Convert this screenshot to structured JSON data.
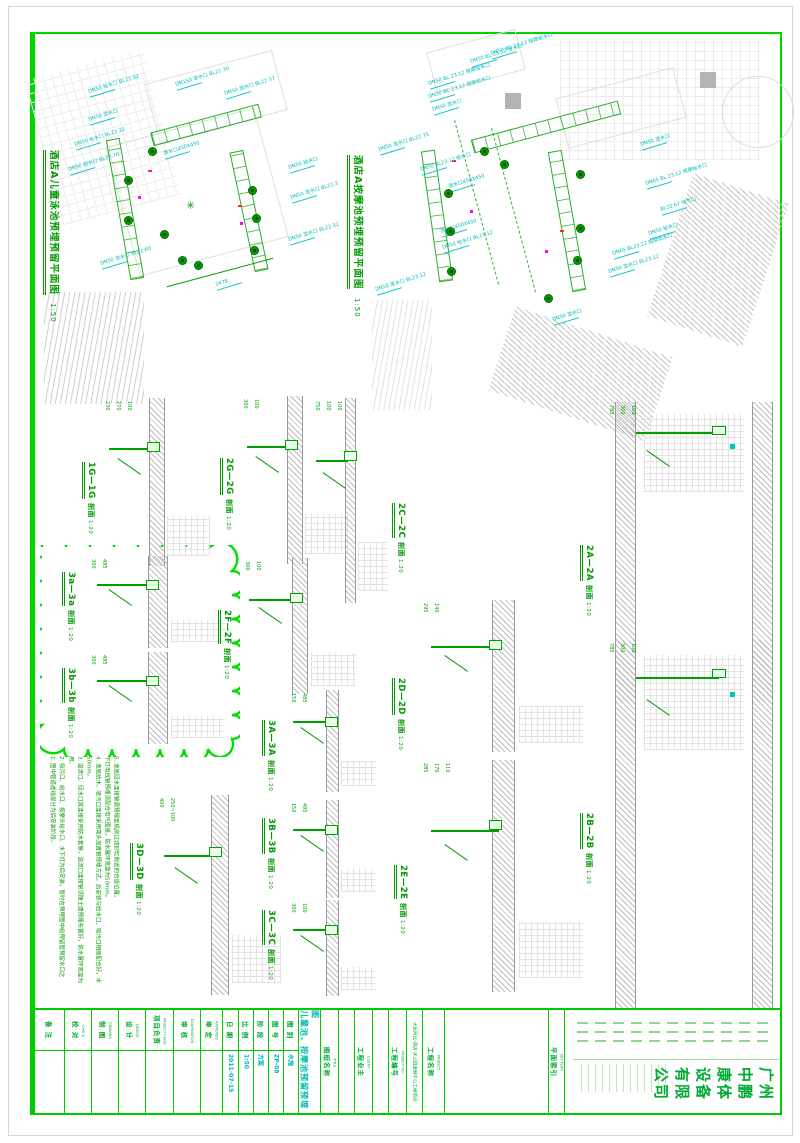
{
  "sheet": {
    "frame_color": "#00d500",
    "drawing_green": "#00a000",
    "label_cyan": "#00b8b8",
    "plan1": {
      "title": "酒店A儿童泳池预埋预留平面图",
      "scale": "1:50",
      "labels": [
        {
          "t": "DN50 给水口 BL22.32",
          "x": 88,
          "y": 90
        },
        {
          "t": "DN50 泄水口",
          "x": 88,
          "y": 118
        },
        {
          "t": "DN150 泄水口 BL22.30",
          "x": 175,
          "y": 83
        },
        {
          "t": "DN50 泄水口 BL22.37",
          "x": 224,
          "y": 92
        },
        {
          "t": "DN50 给水口 BL22.32",
          "x": 74,
          "y": 143
        },
        {
          "t": "泄水口450X450",
          "x": 163,
          "y": 152
        },
        {
          "t": "DN50 回水口 BL22.70",
          "x": 68,
          "y": 168
        },
        {
          "t": "DN50 泄水口 BL22.60",
          "x": 100,
          "y": 262
        },
        {
          "t": "DN50 给水口",
          "x": 288,
          "y": 166
        },
        {
          "t": "DN50 泄水口 BL22.3",
          "x": 290,
          "y": 196
        },
        {
          "t": "DN50 泄水口 BL22.32",
          "x": 288,
          "y": 238
        },
        {
          "t": "2478",
          "x": 215,
          "y": 283
        }
      ],
      "symbols": [
        [
          148,
          147
        ],
        [
          124,
          176
        ],
        [
          124,
          216
        ],
        [
          178,
          256
        ],
        [
          248,
          186
        ],
        [
          252,
          214
        ],
        [
          250,
          246
        ],
        [
          194,
          261
        ],
        [
          160,
          230
        ]
      ]
    },
    "plan2": {
      "title": "酒店A按摩池预埋预留平面图",
      "scale": "1:50",
      "labels": [
        {
          "t": "DN50 BL 23.12 泄水口",
          "x": 470,
          "y": 60
        },
        {
          "t": "DN50 BC 23.12 按摩给水口",
          "x": 490,
          "y": 52
        },
        {
          "t": "DN50 BL 23.12 按摩给水口",
          "x": 428,
          "y": 82
        },
        {
          "t": "DN50 BC 23.12 按摩给水口",
          "x": 428,
          "y": 95
        },
        {
          "t": "DN50 泄水口",
          "x": 432,
          "y": 108
        },
        {
          "t": "DN50 泄水口 BL22.75",
          "x": 378,
          "y": 148
        },
        {
          "t": "DN50 BL23.12 吸水口",
          "x": 420,
          "y": 168
        },
        {
          "t": "泄水口450X450",
          "x": 448,
          "y": 185
        },
        {
          "t": "DN50 泄水口",
          "x": 640,
          "y": 143
        },
        {
          "t": "DN65 BL 23.12 按摩给水口",
          "x": 645,
          "y": 182
        },
        {
          "t": "BL22.67 排气口",
          "x": 660,
          "y": 208
        },
        {
          "t": "DN50 给水口",
          "x": 648,
          "y": 232
        },
        {
          "t": "泄水口450X450",
          "x": 440,
          "y": 230
        },
        {
          "t": "DN50 给水口 BL23.12",
          "x": 442,
          "y": 246
        },
        {
          "t": "DN65 BL23.12 按摩给水口",
          "x": 612,
          "y": 252
        },
        {
          "t": "DN50 泄水口 BL23.12",
          "x": 608,
          "y": 270
        },
        {
          "t": "DN50 泄水口 BL23.12",
          "x": 375,
          "y": 288
        },
        {
          "t": "DN50 泄水口",
          "x": 552,
          "y": 318
        }
      ],
      "symbols": [
        [
          480,
          147
        ],
        [
          576,
          170
        ],
        [
          444,
          189
        ],
        [
          446,
          227
        ],
        [
          576,
          224
        ],
        [
          573,
          256
        ],
        [
          544,
          294
        ],
        [
          447,
          267
        ],
        [
          500,
          160
        ]
      ]
    },
    "sections": [
      {
        "name": "1G—1G",
        "type": "剖面",
        "scale": "1:20",
        "tx": 86,
        "ty": 462,
        "dx": 100,
        "dy": 398,
        "dw": 112,
        "dh": 168,
        "tall": false,
        "dims": [
          "230",
          "270",
          "100"
        ]
      },
      {
        "name": "2G—2G",
        "type": "剖面",
        "scale": "1:20",
        "tx": 224,
        "ty": 458,
        "dx": 238,
        "dy": 396,
        "dw": 112,
        "dh": 168,
        "tall": false,
        "dims": [
          "300",
          "100"
        ]
      },
      {
        "name": "2C—2C",
        "type": "剖面",
        "scale": "1:20",
        "tx": 396,
        "ty": 503,
        "dx": 310,
        "dy": 398,
        "dw": 80,
        "dh": 205,
        "tall": false,
        "dims": [
          "750",
          "100",
          "100"
        ]
      },
      {
        "name": "2A—2A",
        "type": "剖面",
        "scale": "1:20",
        "tx": 584,
        "ty": 545,
        "dx": 604,
        "dy": 402,
        "dw": 180,
        "dh": 300,
        "tall": true,
        "dims": [
          "785",
          "300",
          "100"
        ]
      },
      {
        "name": "3a—3a",
        "type": "剖面",
        "scale": "1:20",
        "tx": 66,
        "ty": 572,
        "dx": 86,
        "dy": 556,
        "dw": 142,
        "dh": 92,
        "tall": false,
        "dims": [
          "300",
          "495"
        ]
      },
      {
        "name": "3b—3b",
        "type": "剖面",
        "scale": "1:20",
        "tx": 66,
        "ty": 668,
        "dx": 86,
        "dy": 652,
        "dw": 142,
        "dh": 92,
        "tall": false,
        "dims": [
          "300",
          "495"
        ]
      },
      {
        "name": "2F—2F",
        "type": "剖面",
        "scale": "1:20",
        "tx": 222,
        "ty": 610,
        "dx": 240,
        "dy": 558,
        "dw": 118,
        "dh": 136,
        "tall": false,
        "dims": [
          "300",
          "100"
        ]
      },
      {
        "name": "2D—2D",
        "type": "剖面",
        "scale": "1:20",
        "tx": 396,
        "ty": 678,
        "dx": 418,
        "dy": 600,
        "dw": 168,
        "dh": 152,
        "tall": false,
        "dims": [
          "295",
          "140"
        ]
      },
      {
        "name": "3A—3A",
        "type": "剖面",
        "scale": "1:20",
        "tx": 266,
        "ty": 720,
        "dx": 286,
        "dy": 690,
        "dw": 92,
        "dh": 102,
        "tall": false,
        "dims": [
          "150",
          "485"
        ]
      },
      {
        "name": "3D—3D",
        "type": "剖面",
        "scale": "1:20",
        "tx": 134,
        "ty": 843,
        "dx": 154,
        "dy": 795,
        "dw": 130,
        "dh": 200,
        "tall": false,
        "dims": [
          "400",
          "250~100"
        ]
      },
      {
        "name": "3B—3B",
        "type": "剖面",
        "scale": "1:20",
        "tx": 266,
        "ty": 818,
        "dx": 286,
        "dy": 800,
        "dw": 92,
        "dh": 98,
        "tall": false,
        "dims": [
          "150",
          "495"
        ]
      },
      {
        "name": "3C—3C",
        "type": "剖面",
        "scale": "1:20",
        "tx": 266,
        "ty": 910,
        "dx": 286,
        "dy": 900,
        "dw": 92,
        "dh": 96,
        "tall": false,
        "dims": [
          "300",
          "100"
        ]
      },
      {
        "name": "2E—2E",
        "type": "剖面",
        "scale": "1:20",
        "tx": 398,
        "ty": 865,
        "dx": 418,
        "dy": 760,
        "dw": 168,
        "dh": 232,
        "tall": false,
        "dims": [
          "285",
          "170",
          "110"
        ]
      },
      {
        "name": "2B—2B",
        "type": "剖面",
        "scale": "1:20",
        "tx": 584,
        "ty": 813,
        "dx": 604,
        "dy": 640,
        "dw": 180,
        "dh": 368,
        "tall": true,
        "dims": [
          "785",
          "300",
          "100"
        ]
      }
    ],
    "notes": [
      "1. 图中管道虚线部分为后安装阶段。",
      "2. 吸污口、给水口、按摩头给水口、水下灯为后安装，暂时在预埋图中给预留管预留水口之用。",
      "3. 溢流口、回水口其连接采用防水套管，溢流口连接管须随土建预埋布置好，防水翼环宽度为50mm。",
      "4. 池底给水、吸污口连接采用弯头加直管预埋方式，后安装与给水口、吸污口相接配合好，水下灯电线管预埋须配合电气图纸，防水翼环宽度为50mm。",
      "5. 池底回水连接管需预埋至机房过滤砂缸附近的合适位置。"
    ],
    "titleblock": {
      "cells": [
        {
          "label": "备 注",
          "en": "",
          "w": 30,
          "type": "sig"
        },
        {
          "label": "校 对",
          "en": "CHECK",
          "w": 27,
          "type": "sig"
        },
        {
          "label": "制 图",
          "en": "DRAWING",
          "w": 27,
          "type": "sig"
        },
        {
          "label": "设 计",
          "en": "DESIGN",
          "w": 27,
          "type": "sig"
        },
        {
          "label": "项目负责",
          "en": "PROJECT CHIEF",
          "w": 28,
          "type": "sig"
        },
        {
          "label": "审 核",
          "en": "EXAMINATION",
          "w": 27,
          "type": "sig"
        },
        {
          "label": "审 定",
          "en": "APPROVED",
          "w": 22,
          "type": "sig"
        },
        {
          "label": "日 期",
          "value": "2011-07-15",
          "w": 16,
          "type": "kv"
        },
        {
          "label": "比 例",
          "value": "1:50",
          "w": 15,
          "type": "kv"
        },
        {
          "label": "阶 段",
          "value": "方案",
          "w": 15,
          "type": "kv"
        },
        {
          "label": "图 号",
          "value": "ZP-08",
          "w": 15,
          "type": "kv"
        },
        {
          "label": "图 别",
          "value": "水施",
          "w": 15,
          "type": "kv"
        },
        {
          "label": "儿童池、按摩池预留预埋图",
          "w": 22,
          "type": "bigtitle"
        },
        {
          "label": "图纸名称",
          "en": "TITLE",
          "w": 18,
          "type": "head"
        },
        {
          "label": "",
          "w": 16,
          "type": "empty"
        },
        {
          "label": "工程业主",
          "en": "CLIENT",
          "w": 18,
          "type": "head"
        },
        {
          "label": "",
          "w": 16,
          "type": "empty"
        },
        {
          "label": "工程编号",
          "en": "PROJECT NO.",
          "w": 18,
          "type": "head"
        },
        {
          "label": "大玩阿比·酒店·水公园度假中心工程项目",
          "w": 16,
          "type": "smalltitle"
        },
        {
          "label": "工程名称",
          "en": "PROJECT",
          "w": 22,
          "type": "head"
        },
        {
          "label": "",
          "w": 104,
          "type": "empty"
        },
        {
          "label": "平面索引",
          "en": "KEY PLAN",
          "w": 16,
          "type": "head"
        },
        {
          "label": "广州中鹏康体设备有限公司",
          "w": 222,
          "type": "company"
        }
      ]
    }
  }
}
